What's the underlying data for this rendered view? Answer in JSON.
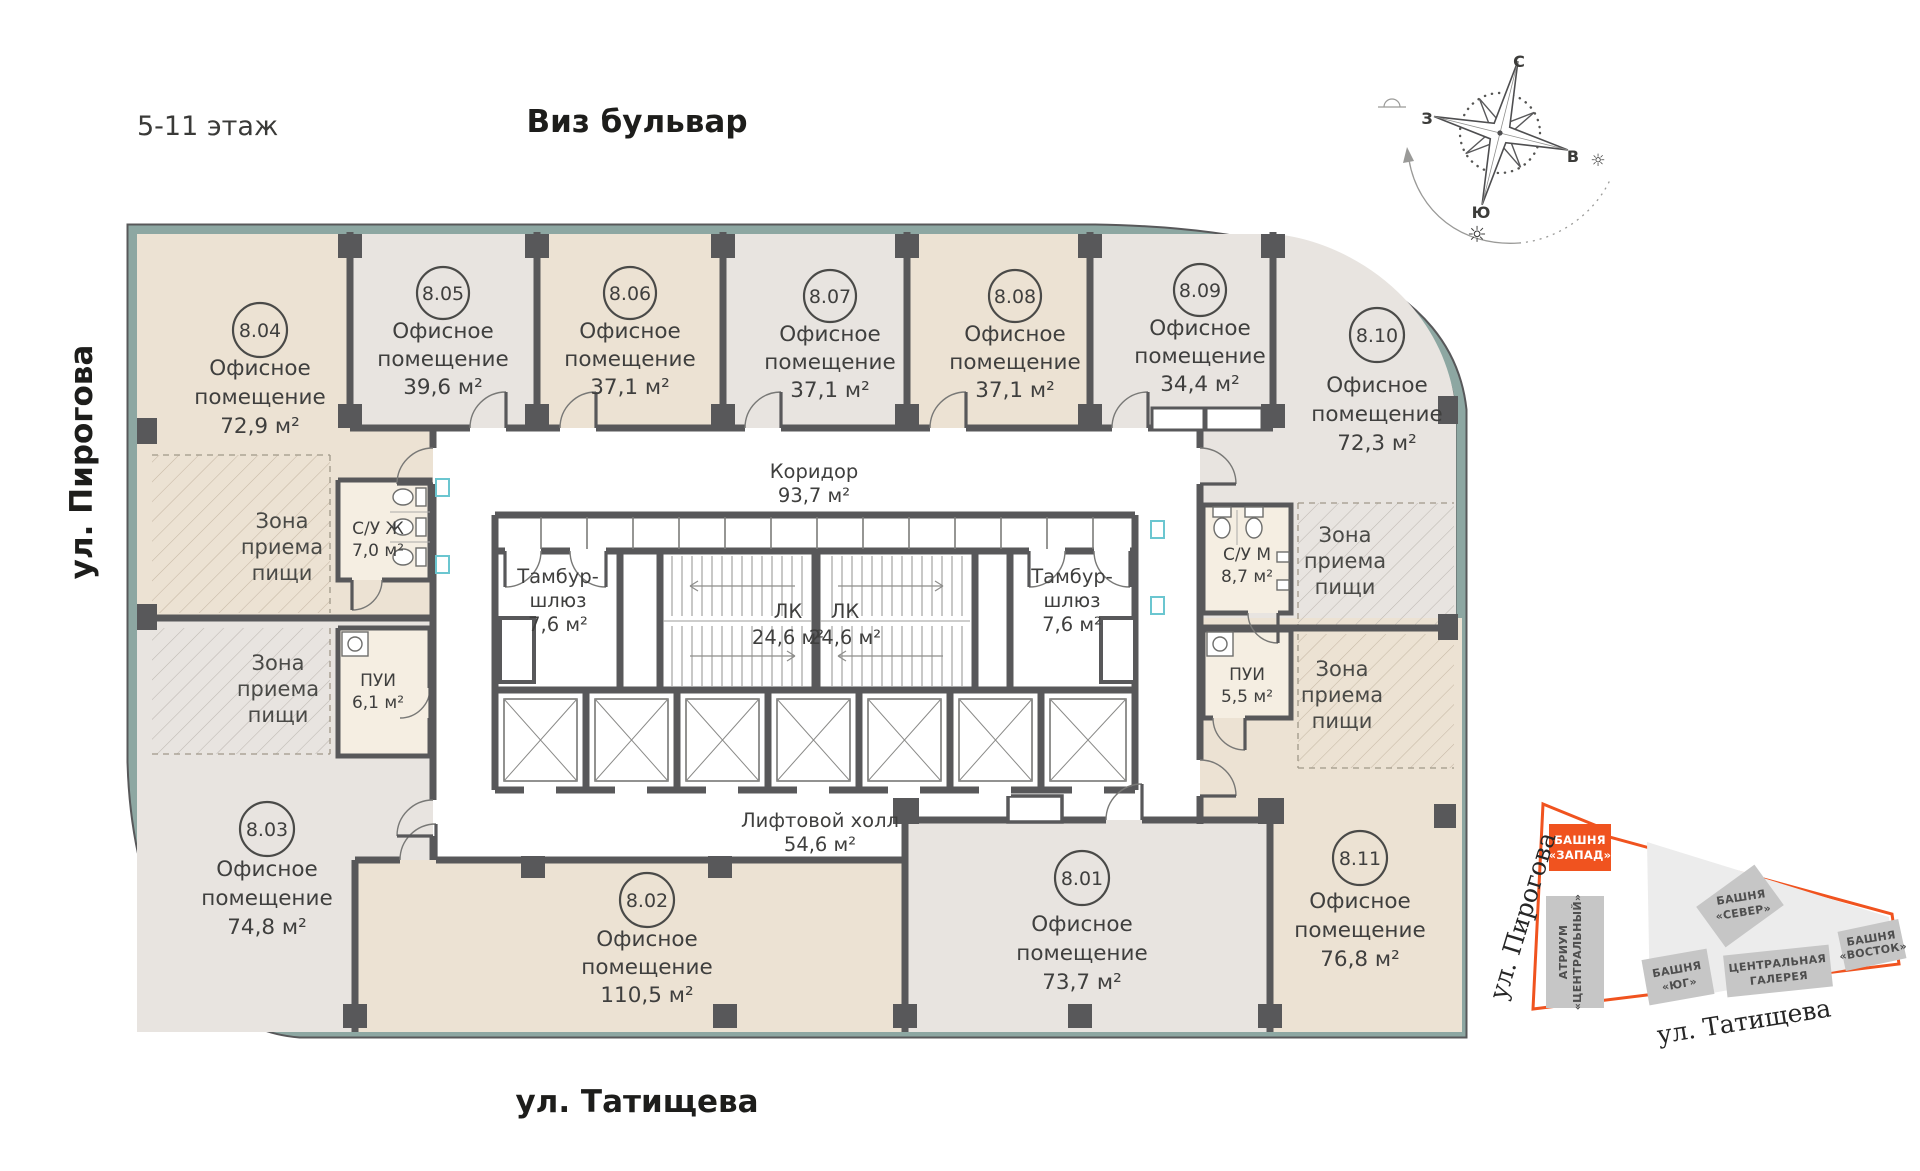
{
  "header": {
    "floor_label": "5-11 этаж",
    "street_top": "Виз бульвар",
    "street_left": "ул. Пирогова",
    "street_bottom": "ул. Татищева"
  },
  "labels": {
    "office1": "Офисное",
    "office2": "помещение"
  },
  "rooms": [
    {
      "number": "8.01",
      "area": "73,7 м²"
    },
    {
      "number": "8.02",
      "area": "110,5 м²"
    },
    {
      "number": "8.03",
      "area": "74,8 м²"
    },
    {
      "number": "8.04",
      "area": "72,9 м²"
    },
    {
      "number": "8.05",
      "area": "39,6 м²"
    },
    {
      "number": "8.06",
      "area": "37,1 м²"
    },
    {
      "number": "8.07",
      "area": "37,1 м²"
    },
    {
      "number": "8.08",
      "area": "37,1 м²"
    },
    {
      "number": "8.09",
      "area": "34,4 м²"
    },
    {
      "number": "8.10",
      "area": "72,3 м²"
    },
    {
      "number": "8.11",
      "area": "76,8 м²"
    }
  ],
  "core": {
    "corridor": "Коридор",
    "corridor_area": "93,7 м²",
    "tambur1": "Тамбур-",
    "tambur2": "шлюз",
    "tambur_area": "7,6 м²",
    "lk": "ЛК",
    "lk_area": "24,6 м²",
    "lift_hall": "Лифтовой холл",
    "lift_area": "54,6 м²"
  },
  "service": {
    "suzh": "С/У Ж",
    "suzh_area": "7,0 м²",
    "sum": "С/У М",
    "sum_area": "8,7 м²",
    "pui": "ПУИ",
    "pui_left_area": "6,1 м²",
    "pui_right_area": "5,5 м²"
  },
  "zone": {
    "l1": "Зона",
    "l2": "приема",
    "l3": "пищи"
  },
  "compass": {
    "n": "С",
    "s": "Ю",
    "w": "З",
    "e": "В"
  },
  "minimap": {
    "tower_west_1": "БАШНЯ",
    "tower_west_2": "«ЗАПАД»",
    "atrium_1": "АТРИУМ",
    "atrium_2": "«ЦЕНТРАЛЬНЫЙ»",
    "tower_north_1": "БАШНЯ",
    "tower_north_2": "«СЕВЕР»",
    "tower_south_1": "БАШНЯ",
    "tower_south_2": "«ЮГ»",
    "gallery_1": "ЦЕНТРАЛЬНАЯ",
    "gallery_2": "ГАЛЕРЕЯ",
    "tower_east_1": "БАШНЯ",
    "tower_east_2": "«ВОСТОК»",
    "street_left": "ул. Пирогова",
    "street_bottom": "ул. Татищева"
  },
  "colors": {
    "accent_orange": "#f0531f",
    "wall_dark": "#58585a",
    "room_beige": "#ece2d3",
    "room_gray": "#e8e4e0",
    "outer_teal": "#8da7a2"
  }
}
